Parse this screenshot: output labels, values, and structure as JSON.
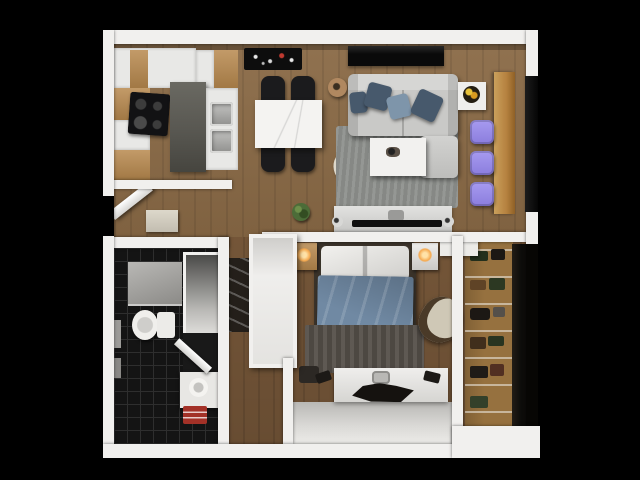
{
  "scene": {
    "title": "Top-down 3D render of a one-bedroom apartment floor plan on a black background",
    "rooms": [
      {
        "name": "Kitchen",
        "furniture": [
          "white upper cabinets",
          "wood cabinet fronts",
          "black induction cooktop",
          "dark gray kitchen island",
          "white counter with double stainless sink"
        ]
      },
      {
        "name": "Dining area",
        "furniture": [
          "white marble dining table",
          "four black dining chairs",
          "black patterned mat",
          "tan floor lamp",
          "cream accent chair with black rim"
        ]
      },
      {
        "name": "Living room",
        "furniture": [
          "light gray sofa with blue pillows",
          "chaise ottoman",
          "gray area rug",
          "white coffee table",
          "white side table with fruit bowl",
          "black window console",
          "wood bar counter",
          "three purple stools",
          "TV console with flat TV",
          "potted plant"
        ]
      },
      {
        "name": "Bedroom",
        "furniture": [
          "double bed with blue duvet and white pillows",
          "two nightstands with lit lamps",
          "dark foot-of-bed rug",
          "cream armchair",
          "white vanity desk with dark chair",
          "black wall sconces",
          "dark ladder shelf",
          "white built-in wardrobe"
        ]
      },
      {
        "name": "Bathroom",
        "furniture": [
          "black tile floor",
          "shower pan",
          "white toilet",
          "white vanity with round basin",
          "red bath mat",
          "open storage niche",
          "open white door"
        ]
      },
      {
        "name": "Walk-in closet",
        "furniture": [
          "wood shelving with clothes and boxes",
          "dark glass panel"
        ]
      },
      {
        "name": "Entry hall",
        "furniture": [
          "open entry door",
          "beige shoe cabinet"
        ]
      }
    ]
  },
  "colors": {
    "background": "#000000",
    "wall": "#f1f0ee",
    "wall_shadow": "#cfcdc9",
    "wood_main": "#8a6a46",
    "wood_bedroom": "#7a5a3b",
    "wood_cabinet": "#b8894e",
    "island_gray": "#585751",
    "counter_white": "#e8e8e6",
    "tile_black": "#141414",
    "tile_line": "#2e2e2e",
    "sofa_gray": "#c9c9c7",
    "rug_gray": "#8e918d",
    "rug_bedroom": "#56504a",
    "pillow_dark": "#47596c",
    "pillow_light": "#7e95aa",
    "duvet_blue": "#7089a3",
    "stool_purple": "#8b7ddd",
    "bar_wood": "#b5813f",
    "glass_dark": "#0d0c0a",
    "mat_black": "#0d0d0d",
    "accent_red": "#a33127",
    "lamp_glow": "#f5a94f",
    "plant_green": "#4c6c38",
    "tv_black": "#101010",
    "south_face": "#d9d8d5"
  }
}
